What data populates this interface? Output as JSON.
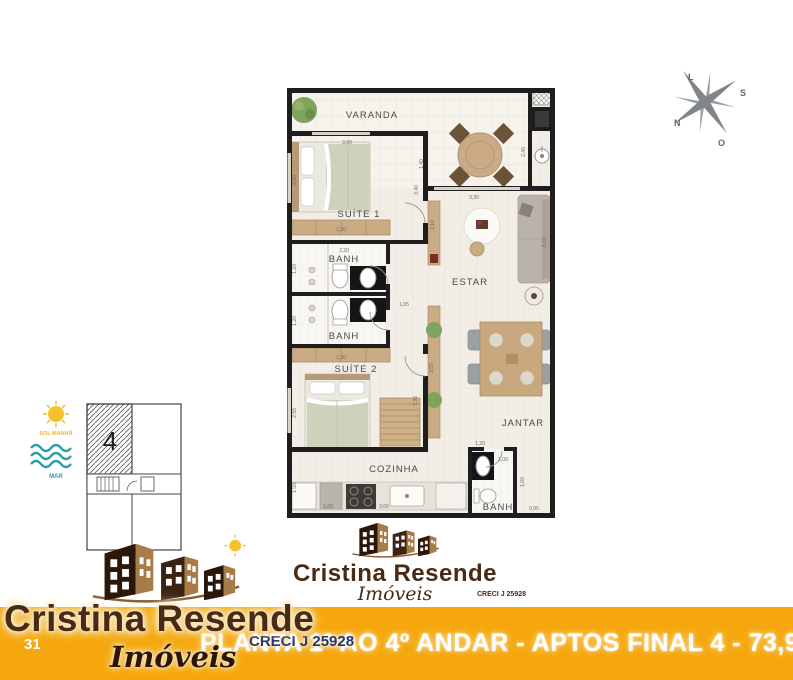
{
  "plan": {
    "rooms": {
      "varanda": "VARANDA",
      "suite1": "SUÍTE 1",
      "banh1": "BANH",
      "banh2": "BANH",
      "suite2": "SUÍTE 2",
      "estar": "ESTAR",
      "jantar": "JANTAR",
      "cozinha": "COZINHA",
      "banh3": "BANH"
    },
    "dims": {
      "suite1_top": "3,80",
      "varanda_depth": "1,40",
      "nook_depth": "2,40",
      "estar_top": "3,30",
      "suite1_left": "2,50",
      "closet1": "2,30",
      "banh1_top": "2,20",
      "banh1_left": "1,20",
      "banh2_left": "1,20",
      "closet2": "2,30",
      "hall_width": "1,05",
      "hall_length": "3,40",
      "console_len": "2,10",
      "suite2_left": "2,55",
      "wardrobe": "1,35",
      "estar_side": "3,55",
      "right_wall": "8,10",
      "kitchen_left": "1,50",
      "kitchen_a": "1,00",
      "kitchen_b": "3,00",
      "banh3_top": "1,20",
      "banh3_a": "1,00",
      "banh3_right": "1,60",
      "banh3_bottom": "0,95"
    }
  },
  "compass": {
    "east": "L",
    "south": "S",
    "north": "N",
    "west": "O"
  },
  "key_plan": {
    "unit": "4",
    "sun_label": "SOL MANHÃ",
    "sea_label": "MAR"
  },
  "logo_center": {
    "brand": "Cristina Resende",
    "subtitle": "Imóveis",
    "creci": "CRECI J 25928"
  },
  "logo_corner": {
    "brand": "Cristina Resende",
    "subtitle": "Imóveis"
  },
  "footer": {
    "bar_color": "#F5A70D",
    "page_number": "31",
    "creci_badge": "CRECI J 25928",
    "caption": "PLANTA 1º AO 4º ANDAR - APTOS FINAL 4 - 73,91M²"
  }
}
